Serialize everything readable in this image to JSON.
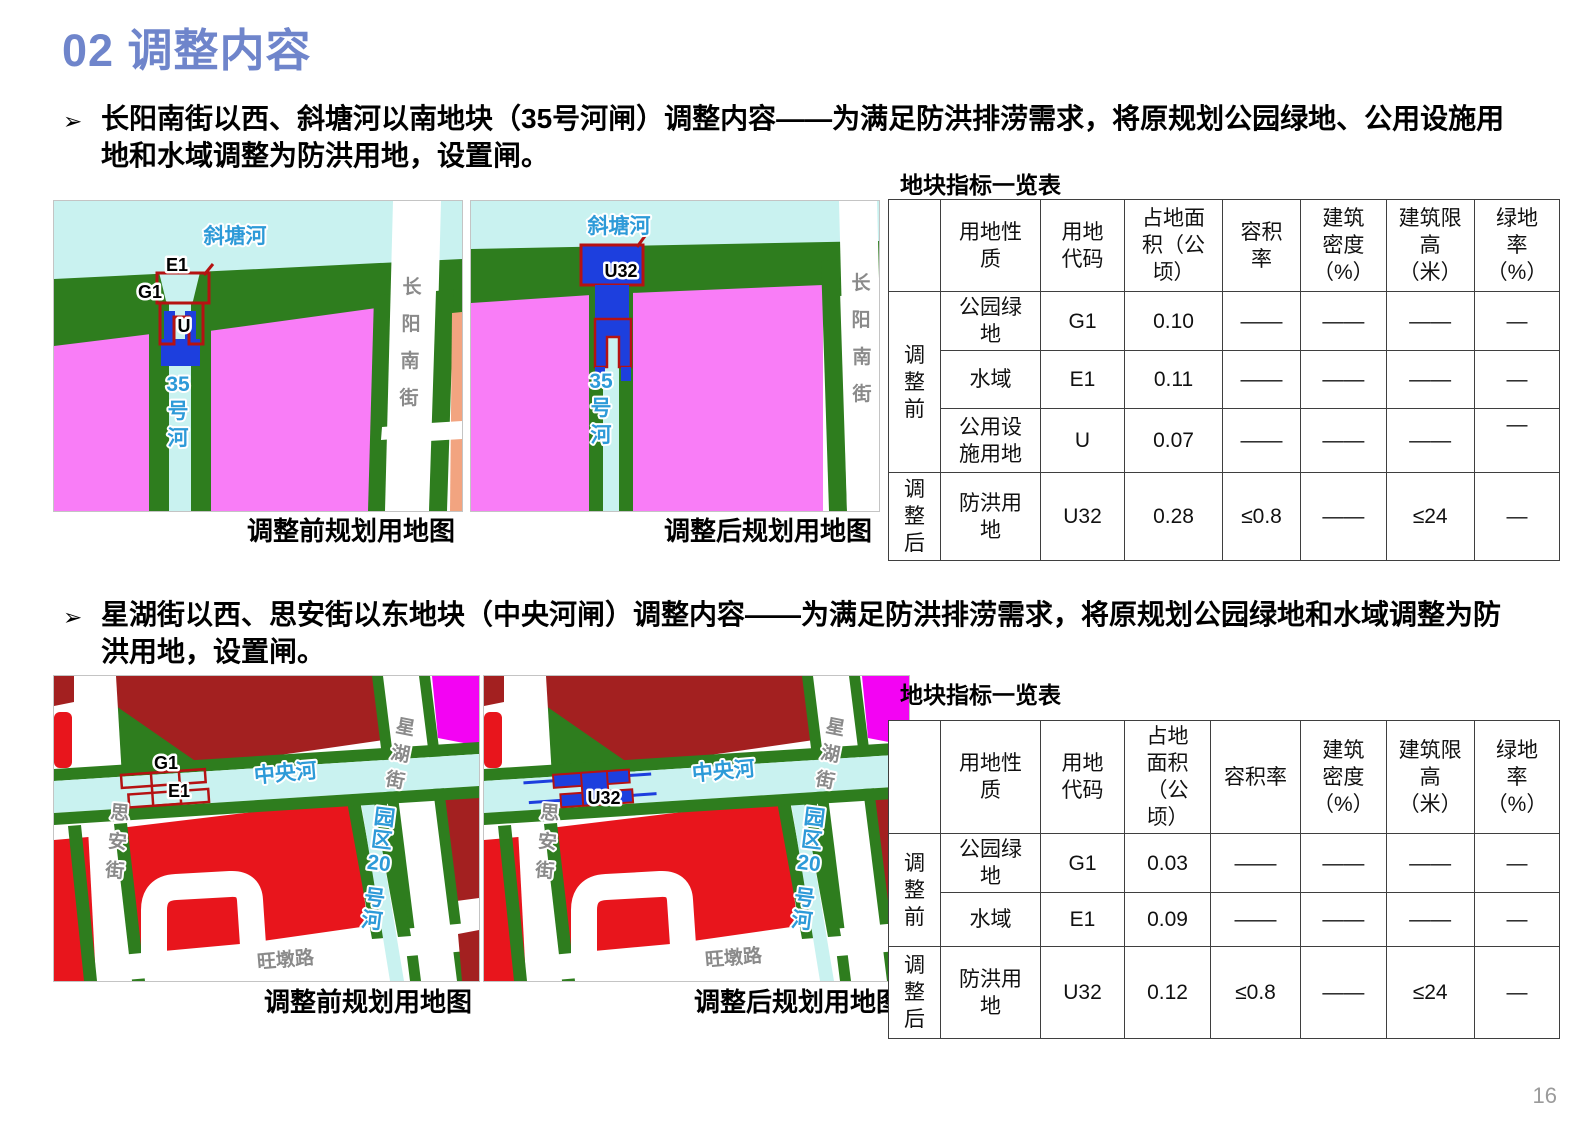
{
  "page": {
    "title": "02 调整内容",
    "page_number": "16"
  },
  "colors": {
    "accent": "#6F85CB",
    "river_cyan": "#C9F2F0",
    "green": "#2E7D1E",
    "pink": "#F97DF7",
    "salmon": "#F2A480",
    "gate_blue": "#1D3FDE",
    "outline_red": "#B51212",
    "dark_red": "#A32020",
    "bright_red": "#E8151C",
    "magenta": "#F303F3",
    "river_label_blue": "#2D9AD8",
    "road_label_gray": "#8A8A8A"
  },
  "section1": {
    "bullet_marker": "➢",
    "bullet": "长阳南街以西、斜塘河以南地块（35号河闸）调整内容——为满足防洪排涝需求，将原规划公园绿地、公用设施用地和水域调整为防洪用地，设置闸。",
    "map_before": {
      "caption": "调整前规划用地图",
      "river_top": "斜塘河",
      "river_vertical": [
        "35",
        "号",
        "河"
      ],
      "road_right": [
        "长",
        "阳",
        "南",
        "街"
      ],
      "zone_e1": "E1",
      "zone_g1": "G1",
      "zone_u": "U"
    },
    "map_after": {
      "caption": "调整后规划用地图",
      "river_top": "斜塘河",
      "river_vertical": [
        "35",
        "号",
        "河"
      ],
      "road_right": [
        "长",
        "阳",
        "南",
        "街"
      ],
      "zone_u32": "U32"
    },
    "table": {
      "title": "地块指标一览表",
      "headers": [
        "",
        "用地性质",
        "用地代码",
        "占地面积（公顷）",
        "容积率",
        "建筑密度（%）",
        "建筑限高（米）",
        "绿地率（%）"
      ],
      "row_groups": [
        {
          "label": "调整前",
          "rows": [
            {
              "nature": "公园绿地",
              "code": "G1",
              "area": "0.10",
              "far": "——",
              "density": "——",
              "height_limit": "——",
              "green_rate": "—"
            },
            {
              "nature": "水域",
              "code": "E1",
              "area": "0.11",
              "far": "——",
              "density": "——",
              "height_limit": "——",
              "green_rate": "—"
            },
            {
              "nature": "公用设施用地",
              "code": "U",
              "area": "0.07",
              "far": "——",
              "density": "——",
              "height_limit": "——",
              "green_rate": "—"
            }
          ]
        },
        {
          "label": "调整后",
          "rows": [
            {
              "nature": "防洪用地",
              "code": "U32",
              "area": "0.28",
              "far": "≤0.8",
              "density": "——",
              "height_limit": "≤24",
              "green_rate": "—"
            }
          ]
        }
      ]
    }
  },
  "section2": {
    "bullet_marker": "➢",
    "bullet": "星湖街以西、思安街以东地块（中央河闸）调整内容——为满足防洪排涝需求，将原规划公园绿地和水域调整为防洪用地，设置闸。",
    "map_before": {
      "caption": "调整前规划用地图",
      "river_horizontal": "中央河",
      "river_vertical": [
        "园",
        "区",
        "20",
        "号",
        "河"
      ],
      "road_left": [
        "思",
        "安",
        "街"
      ],
      "road_right": [
        "星",
        "湖",
        "街"
      ],
      "road_bottom": "旺墩路",
      "zone_g1": "G1",
      "zone_e1": "E1"
    },
    "map_after": {
      "caption": "调整后规划用地图",
      "river_horizontal": "中央河",
      "river_vertical": [
        "园",
        "区",
        "20",
        "号",
        "河"
      ],
      "road_left": [
        "思",
        "安",
        "街"
      ],
      "road_right": [
        "星",
        "湖",
        "街"
      ],
      "road_bottom": "旺墩路",
      "zone_u32": "U32"
    },
    "table": {
      "title": "地块指标一览表",
      "headers": [
        "",
        "用地性质",
        "用地代码",
        "占地面积（公顷）",
        "容积率",
        "建筑密度（%）",
        "建筑限高（米）",
        "绿地率（%）"
      ],
      "row_groups": [
        {
          "label": "调整前",
          "rows": [
            {
              "nature": "公园绿地",
              "code": "G1",
              "area": "0.03",
              "far": "——",
              "density": "——",
              "height_limit": "——",
              "green_rate": "—"
            },
            {
              "nature": "水域",
              "code": "E1",
              "area": "0.09",
              "far": "——",
              "density": "——",
              "height_limit": "——",
              "green_rate": "—"
            }
          ]
        },
        {
          "label": "调整后",
          "rows": [
            {
              "nature": "防洪用地",
              "code": "U32",
              "area": "0.12",
              "far": "≤0.8",
              "density": "——",
              "height_limit": "≤24",
              "green_rate": "—"
            }
          ]
        }
      ]
    }
  }
}
